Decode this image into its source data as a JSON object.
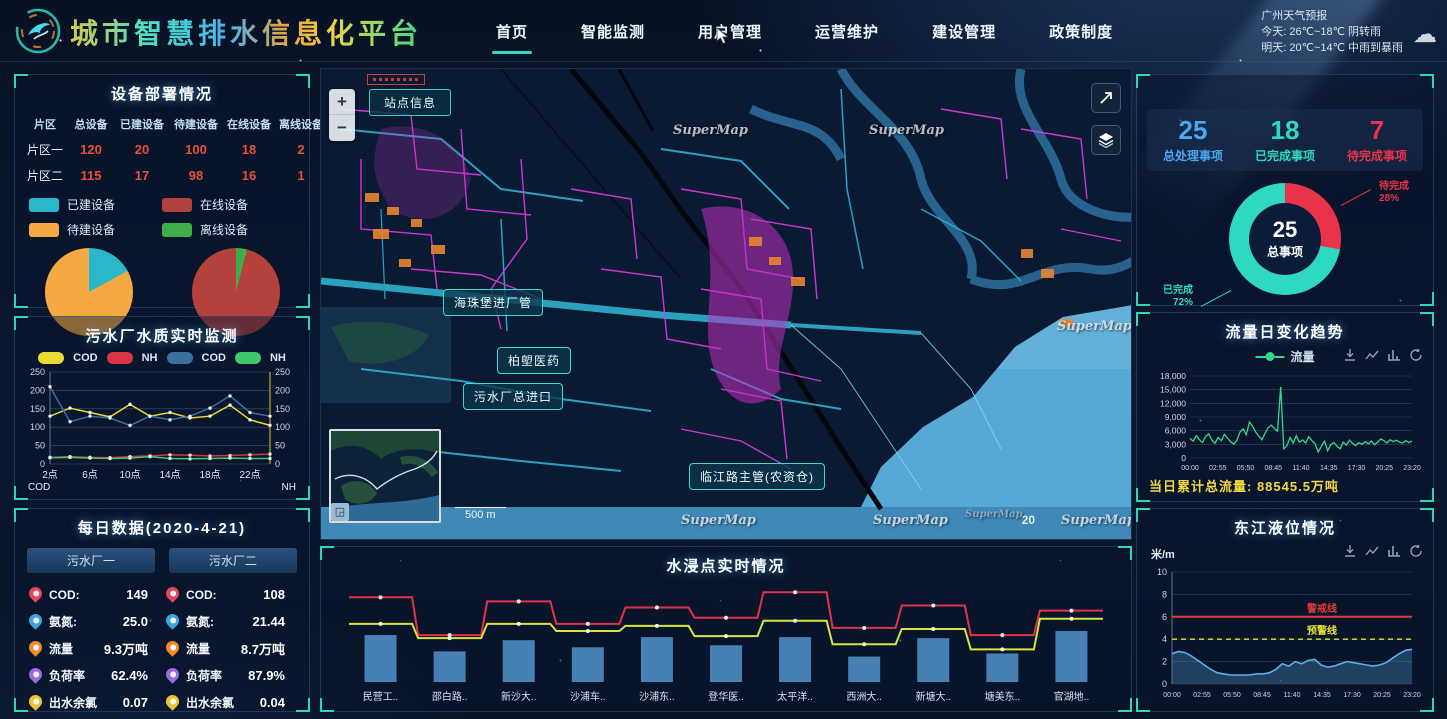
{
  "header": {
    "title": "城市智慧排水信息化平台",
    "nav": [
      {
        "label": "首页",
        "active": true
      },
      {
        "label": "智能监测",
        "active": false
      },
      {
        "label": "用户管理",
        "active": false
      },
      {
        "label": "运营维护",
        "active": false
      },
      {
        "label": "建设管理",
        "active": false
      },
      {
        "label": "政策制度",
        "active": false
      }
    ],
    "weather": {
      "city_line": "广州天气预报",
      "today": "今天: 26℃~18℃ 阴转雨",
      "tomorrow": "明天: 20℃~14℃ 中雨到暴雨",
      "icon": "cloud-icon"
    }
  },
  "device_panel": {
    "title": "设备部署情况",
    "table": {
      "headers": [
        "片区",
        "总设备",
        "已建设备",
        "待建设备",
        "在线设备",
        "离线设备"
      ],
      "rows": [
        {
          "name": "片区一",
          "values": [
            "120",
            "20",
            "100",
            "18",
            "2"
          ]
        },
        {
          "name": "片区二",
          "values": [
            "115",
            "17",
            "98",
            "16",
            "1"
          ]
        }
      ]
    },
    "legend": [
      {
        "label": "已建设备",
        "color": "#2ab7c9"
      },
      {
        "label": "在线设备",
        "color": "#b5413c"
      },
      {
        "label": "待建设备",
        "color": "#f5a942"
      },
      {
        "label": "离线设备",
        "color": "#3fae4a"
      }
    ]
  },
  "quality_panel": {
    "title": "污水厂水质实时监测"
  },
  "daily_panel": {
    "title": "每日数据(2020-4-21)",
    "plants": [
      "污水厂一",
      "污水厂二"
    ],
    "rows": [
      {
        "icon": "location-pin-red-icon",
        "label": "COD:",
        "v1": "149",
        "v2": "108"
      },
      {
        "icon": "location-pin-blue-icon",
        "label": "氨氮:",
        "v1": "25.0",
        "v2": "21.44"
      },
      {
        "icon": "location-pin-orange-icon",
        "label": "流量",
        "v1": "9.3万吨",
        "v2": "8.7万吨"
      },
      {
        "icon": "location-pin-purple-icon",
        "label": "负荷率",
        "v1": "62.4%",
        "v2": "87.9%"
      },
      {
        "icon": "location-pin-yellow-icon",
        "label": "出水余氯",
        "v1": "0.07",
        "v2": "0.04"
      }
    ]
  },
  "map": {
    "station_button": "站点信息",
    "zoom_in": "+",
    "zoom_out": "−",
    "labels": [
      "海珠堡进厂管",
      "柏塱医药",
      "污水厂总进口",
      "临江路主管(农资仓)"
    ],
    "scale_text": "500 m",
    "zoom_level": "20",
    "watermark": "SuperMap",
    "minimap_button": "◲"
  },
  "flood_panel": {
    "title": "水浸点实时情况"
  },
  "stats_panel": {
    "items": [
      {
        "value": "25",
        "label": "总处理事项",
        "color": "#4aa8f0"
      },
      {
        "value": "18",
        "label": "已完成事项",
        "color": "#2fd9c0"
      },
      {
        "value": "7",
        "label": "待完成事项",
        "color": "#e8334a"
      }
    ]
  },
  "flow_panel": {
    "title": "流量日变化趋势",
    "legend_label": "流量",
    "footer": "当日累计总流量: 88545.5万吨"
  },
  "level_panel": {
    "title": "东江液位情况",
    "y_unit": "米/m"
  },
  "chart_data": {
    "quality": {
      "type": "line",
      "x_hours": [
        2,
        4,
        6,
        8,
        10,
        12,
        14,
        16,
        18,
        20,
        22,
        24
      ],
      "x_ticks": [
        "2点",
        "6点",
        "10点",
        "14点",
        "18点",
        "22点"
      ],
      "ylim": [
        0,
        250
      ],
      "y_ticks": [
        0,
        50,
        100,
        150,
        200,
        250
      ],
      "axis_left": "COD",
      "axis_right": "NH",
      "series": [
        {
          "name": "COD",
          "color": "#e8d935",
          "values": [
            130,
            152,
            140,
            128,
            162,
            130,
            140,
            125,
            130,
            160,
            120,
            105
          ]
        },
        {
          "name": "NH",
          "color": "#d93545",
          "values": [
            18,
            20,
            18,
            17,
            20,
            22,
            25,
            24,
            22,
            23,
            25,
            27
          ]
        },
        {
          "name": "COD",
          "color": "#3a6fa0",
          "values": [
            210,
            115,
            130,
            125,
            105,
            130,
            120,
            130,
            152,
            185,
            140,
            130
          ]
        },
        {
          "name": "NH",
          "color": "#3fc86a",
          "values": [
            17,
            18,
            16,
            15,
            16,
            20,
            15,
            14,
            15,
            16,
            15,
            15
          ]
        }
      ]
    },
    "flood": {
      "type": "bar+line",
      "categories": [
        "民营工..",
        "邵白路..",
        "新沙大..",
        "沙浦车..",
        "沙浦东..",
        "登华医..",
        "太平洋..",
        "西洲大..",
        "新塘大..",
        "塘美东..",
        "官湖地.."
      ],
      "ylim": [
        0,
        10
      ],
      "bar": {
        "color": "#4b86bc",
        "values": [
          4.6,
          3.0,
          4.1,
          3.4,
          4.4,
          3.6,
          4.4,
          2.5,
          4.3,
          2.8,
          5.0
        ]
      },
      "lines": [
        {
          "color": "#e0324b",
          "values": [
            8.3,
            4.6,
            7.9,
            5.7,
            7.3,
            6.3,
            8.8,
            5.3,
            7.5,
            4.6,
            7.0
          ]
        },
        {
          "color": "#d9e33c",
          "values": [
            5.7,
            4.3,
            5.7,
            5.0,
            5.5,
            4.5,
            6.0,
            3.7,
            5.2,
            3.2,
            6.2
          ]
        }
      ]
    },
    "flow": {
      "type": "line",
      "name": "流量",
      "color": "#35d98a",
      "ylim": [
        0,
        18000
      ],
      "y_ticks": [
        "18,000",
        "15,000",
        "12,000",
        "9,000",
        "6,000",
        "3,000",
        "0"
      ],
      "x_ticks": [
        "00:00",
        "02:55",
        "05:50",
        "08:45",
        "11:40",
        "14:35",
        "17:30",
        "20:25",
        "23:20"
      ],
      "values": [
        4300,
        3700,
        4900,
        4000,
        3400,
        4700,
        5300,
        3900,
        3200,
        4500,
        3800,
        5200,
        4400,
        3600,
        3000,
        3900,
        5700,
        6400,
        5100,
        7900,
        7000,
        5700,
        4800,
        4000,
        5400,
        6700,
        7200,
        6500,
        5900,
        15600,
        2000,
        2700,
        4500,
        3300,
        4900,
        3500,
        4000,
        3300,
        4700,
        3800,
        3100,
        1300,
        2500,
        3700,
        1600,
        2900,
        3400,
        2600,
        2000,
        3500,
        2800,
        3900,
        3200,
        2700,
        3400,
        3000,
        3600,
        3100,
        3700,
        2900,
        3500,
        4200,
        3800,
        3300,
        4000,
        3600,
        3900,
        3500,
        3300,
        3800,
        3400,
        3700
      ]
    },
    "level": {
      "type": "area",
      "color": "#59b0e8",
      "ylim": [
        0,
        10
      ],
      "y_ticks": [
        10,
        8,
        6,
        4,
        2,
        0
      ],
      "x_ticks": [
        "00:00",
        "02:55",
        "05:50",
        "08:45",
        "11:40",
        "14:35",
        "17:30",
        "20:25",
        "23:20"
      ],
      "ref_lines": [
        {
          "label": "警戒线",
          "value": 6,
          "color": "#e03c3c",
          "style": "solid"
        },
        {
          "label": "预警线",
          "value": 4,
          "color": "#e8e337",
          "style": "dashed"
        }
      ],
      "values": [
        2.7,
        2.9,
        2.8,
        2.5,
        2.1,
        1.7,
        1.3,
        1.0,
        0.9,
        0.8,
        0.8,
        0.8,
        0.8,
        0.9,
        0.9,
        1.0,
        1.3,
        1.8,
        1.6,
        2.0,
        1.8,
        2.1,
        2.2,
        1.7,
        1.5,
        1.6,
        1.8,
        2.0,
        1.9,
        1.8,
        1.7,
        1.6,
        1.7,
        1.9,
        2.3,
        2.7,
        3.0,
        3.1
      ]
    },
    "pie_build": {
      "type": "pie",
      "slices": [
        {
          "label": "已建设备",
          "value": 17,
          "color": "#2ab7c9"
        },
        {
          "label": "待建设备",
          "value": 83,
          "color": "#f5a942"
        }
      ]
    },
    "pie_online": {
      "type": "pie",
      "slices": [
        {
          "label": "离线设备",
          "value": 4,
          "color": "#3fae4a"
        },
        {
          "label": "在线设备",
          "value": 96,
          "color": "#b5413c"
        }
      ]
    },
    "donut": {
      "type": "pie",
      "center_value": "25",
      "center_label": "总事项",
      "slices": [
        {
          "label": "待完成",
          "value": 28,
          "pct_text": "28%",
          "color": "#e8334a"
        },
        {
          "label": "已完成",
          "value": 72,
          "pct_text": "72%",
          "color": "#2fd9c0"
        }
      ]
    }
  }
}
